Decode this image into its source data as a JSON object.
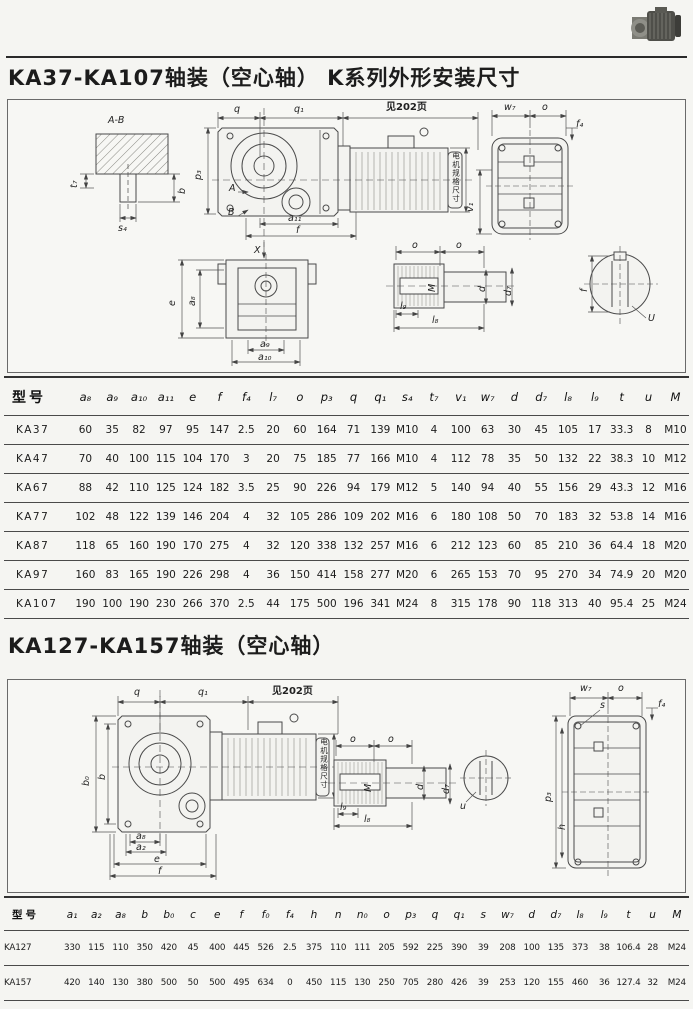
{
  "colors": {
    "paper": "#f5f5f2",
    "ink": "#1c1c1c",
    "line": "#4a4a4a"
  },
  "titles": {
    "t1": "KA37-KA107轴装（空心轴）  K系列外形安装尺寸",
    "t2": "KA127-KA157轴装（空心轴）"
  },
  "diagram1": {
    "labels": {
      "ab": "A-B",
      "t7": "t₇",
      "b": "b",
      "s4": "s₄",
      "q": "q",
      "q1": "q₁",
      "see": "见202页",
      "p3": "p₃",
      "A": "A",
      "B": "B",
      "a11": "a₁₁",
      "f": "f",
      "X": "X",
      "e": "e",
      "a8": "a₈",
      "a9": "a₉",
      "a10": "a₁₀",
      "o": "o",
      "M": "M",
      "d": "d",
      "d7": "d₇",
      "l9": "l₉",
      "l8": "l₈",
      "w7": "w₇",
      "f4": "f₄",
      "v1": "v₁",
      "cf": "f",
      "U": "U",
      "motor": "电机规格尺寸"
    }
  },
  "diagram2": {
    "labels": {
      "q": "q",
      "q1": "q₁",
      "see": "见202页",
      "b0": "b₀",
      "b": "b",
      "a8": "a₈",
      "a2": "a₂",
      "e": "e",
      "f": "f",
      "o": "o",
      "M": "M",
      "d": "d",
      "d7": "d₇",
      "l9": "l₉",
      "l8": "l₈",
      "u": "u",
      "w7": "w₇",
      "s": "s",
      "f4": "f₄",
      "p3": "p₃",
      "h": "h",
      "motor": "电机规格尺寸"
    }
  },
  "table1": {
    "headers": [
      "型号",
      "a₈",
      "a₉",
      "a₁₀",
      "a₁₁",
      "e",
      "f",
      "f₄",
      "l₇",
      "o",
      "p₃",
      "q",
      "q₁",
      "s₄",
      "t₇",
      "v₁",
      "w₇",
      "d",
      "d₇",
      "l₈",
      "l₉",
      "t",
      "u",
      "M"
    ],
    "rows": [
      {
        "model": "KA37",
        "values": [
          "60",
          "35",
          "82",
          "97",
          "95",
          "147",
          "2.5",
          "20",
          "60",
          "164",
          "71",
          "139",
          "M10",
          "4",
          "100",
          "63",
          "30",
          "45",
          "105",
          "17",
          "33.3",
          "8",
          "M10"
        ]
      },
      {
        "model": "KA47",
        "values": [
          "70",
          "40",
          "100",
          "115",
          "104",
          "170",
          "3",
          "20",
          "75",
          "185",
          "77",
          "166",
          "M10",
          "4",
          "112",
          "78",
          "35",
          "50",
          "132",
          "22",
          "38.3",
          "10",
          "M12"
        ]
      },
      {
        "model": "KA67",
        "values": [
          "88",
          "42",
          "110",
          "125",
          "124",
          "182",
          "3.5",
          "25",
          "90",
          "226",
          "94",
          "179",
          "M12",
          "5",
          "140",
          "94",
          "40",
          "55",
          "156",
          "29",
          "43.3",
          "12",
          "M16"
        ]
      },
      {
        "model": "KA77",
        "values": [
          "102",
          "48",
          "122",
          "139",
          "146",
          "204",
          "4",
          "32",
          "105",
          "286",
          "109",
          "202",
          "M16",
          "6",
          "180",
          "108",
          "50",
          "70",
          "183",
          "32",
          "53.8",
          "14",
          "M16"
        ]
      },
      {
        "model": "KA87",
        "values": [
          "118",
          "65",
          "160",
          "190",
          "170",
          "275",
          "4",
          "32",
          "120",
          "338",
          "132",
          "257",
          "M16",
          "6",
          "212",
          "123",
          "60",
          "85",
          "210",
          "36",
          "64.4",
          "18",
          "M20"
        ]
      },
      {
        "model": "KA97",
        "values": [
          "160",
          "83",
          "165",
          "190",
          "226",
          "298",
          "4",
          "36",
          "150",
          "414",
          "158",
          "277",
          "M20",
          "6",
          "265",
          "153",
          "70",
          "95",
          "270",
          "34",
          "74.9",
          "20",
          "M20"
        ]
      },
      {
        "model": "KA107",
        "values": [
          "190",
          "100",
          "190",
          "230",
          "266",
          "370",
          "2.5",
          "44",
          "175",
          "500",
          "196",
          "341",
          "M24",
          "8",
          "315",
          "178",
          "90",
          "118",
          "313",
          "40",
          "95.4",
          "25",
          "M24"
        ]
      }
    ]
  },
  "table2": {
    "headers": [
      "型号",
      "a₁",
      "a₂",
      "a₈",
      "b",
      "b₀",
      "c",
      "e",
      "f",
      "f₀",
      "f₄",
      "h",
      "n",
      "n₀",
      "o",
      "p₃",
      "q",
      "q₁",
      "s",
      "w₇",
      "d",
      "d₇",
      "l₈",
      "l₉",
      "t",
      "u",
      "M"
    ],
    "rows": [
      {
        "model": "KA127",
        "values": [
          "330",
          "115",
          "110",
          "350",
          "420",
          "45",
          "400",
          "445",
          "526",
          "2.5",
          "375",
          "110",
          "111",
          "205",
          "592",
          "225",
          "390",
          "39",
          "208",
          "100",
          "135",
          "373",
          "38",
          "106.4",
          "28",
          "M24"
        ]
      },
      {
        "model": "KA157",
        "values": [
          "420",
          "140",
          "130",
          "380",
          "500",
          "50",
          "500",
          "495",
          "634",
          "0",
          "450",
          "115",
          "130",
          "250",
          "705",
          "280",
          "426",
          "39",
          "253",
          "120",
          "155",
          "460",
          "36",
          "127.4",
          "32",
          "M24"
        ]
      }
    ]
  }
}
